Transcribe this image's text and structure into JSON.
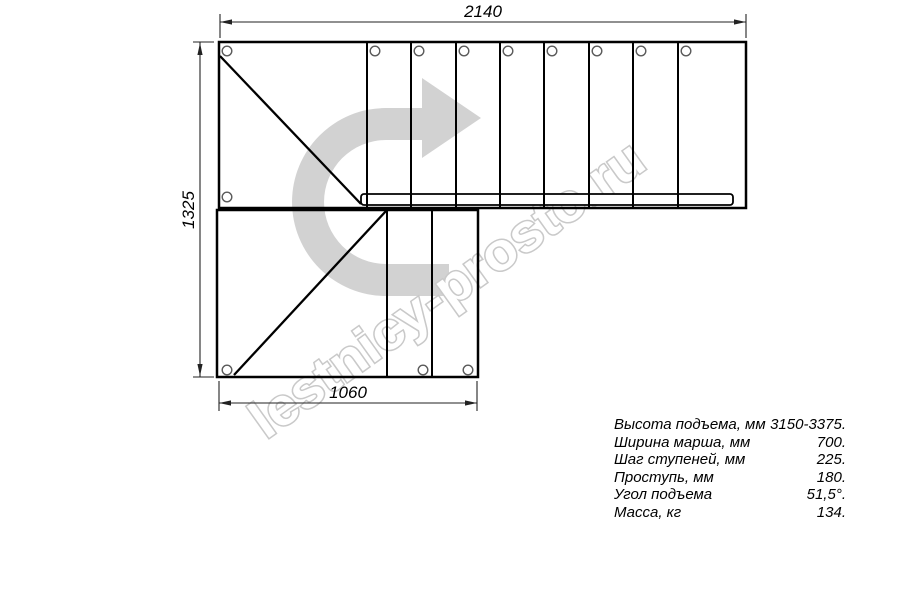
{
  "meta": {
    "title": "Staircase plan technical drawing with 90-degree turn",
    "background": "#ffffff",
    "line_color": "#000000"
  },
  "watermark": {
    "text": "lestnicy-prosto.ru",
    "arrow_icon": "turn-right-curved-arrow",
    "arrow_color": "#d2d2d2",
    "text_fill": "#ffffff",
    "text_outline": "#c9c9c9"
  },
  "dimensions": {
    "top": "2140",
    "left": "1325",
    "bottom": "1060"
  },
  "specs": {
    "rows": [
      {
        "label": "Высота подъема, мм",
        "value": "3150-3375."
      },
      {
        "label": "Ширина марша, мм",
        "value": "700."
      },
      {
        "label": "Шаг ступеней, мм",
        "value": "225."
      },
      {
        "label": "Проступь, мм",
        "value": "180."
      },
      {
        "label": "Угол подъема",
        "value": "51,5°."
      },
      {
        "label": "Масса, кг",
        "value": "134."
      }
    ]
  }
}
